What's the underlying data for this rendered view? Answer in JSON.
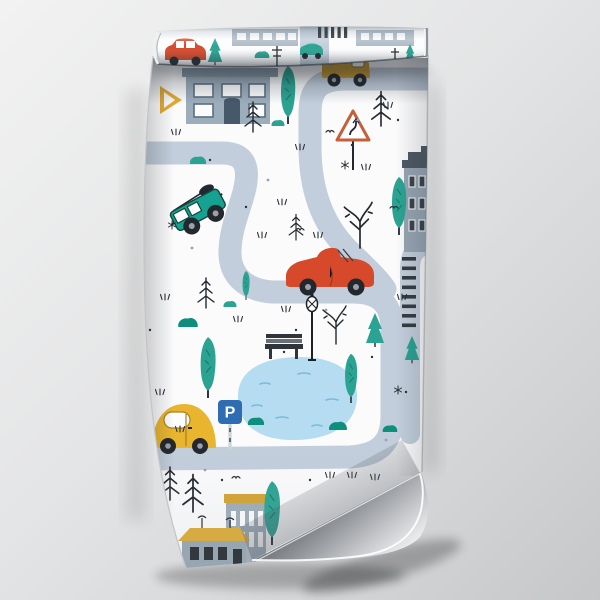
{
  "scene": {
    "type": "product mockup photograph",
    "subject": "Rolled wallpaper sample hanging on a gray wall, rolled over at the top, bottom-right corner curling up and showing the silver paper back",
    "background": "soft gray studio gradient"
  },
  "pattern": {
    "theme": "hand-drawn kids road map with cars, houses, trees and a pond",
    "base_color": "#fbfbfc",
    "road_color": "#c2cedb",
    "elements": [
      "winding road",
      "zebra crosswalk",
      "teal SUV driving downhill",
      "red convertible",
      "yellow beetle car",
      "mustard pickup truck",
      "small red car on roll",
      "small teal car on roll",
      "gray house with dark door",
      "gray corner house",
      "apartment block with mustard band",
      "cottage with mustard roof",
      "pond with waves",
      "park bench",
      "street lamp",
      "curve warning sign",
      "parking sign",
      "yellow yield sign",
      "teal poplar trees",
      "teal pines",
      "black sketch pines",
      "bare winter trees",
      "teal bushes",
      "grass tufts",
      "birds",
      "ink speckles"
    ],
    "parking_sign": {
      "letter": "P",
      "color": "#2e6cb4"
    },
    "palette": {
      "teal": "#16a291",
      "tree_teal": "#2ca392",
      "dark_teal": "#0d8f7c",
      "red": "#d6492b",
      "beetle_yellow": "#e9b52f",
      "pickup_mustard": "#c8992e",
      "mustard_roof": "#dcab36",
      "house_gray": "#9cadbb",
      "window_frame": "#5d6e7e",
      "pond_blue": "#b5dcf0",
      "wave_blue": "#79bcd9",
      "sign_border": "#c45f3a",
      "ink": "#23282e",
      "paper_back_silver": "#c4c6c9"
    }
  },
  "mockup": {
    "roll_position": "top",
    "curl_position": "bottom-right"
  }
}
